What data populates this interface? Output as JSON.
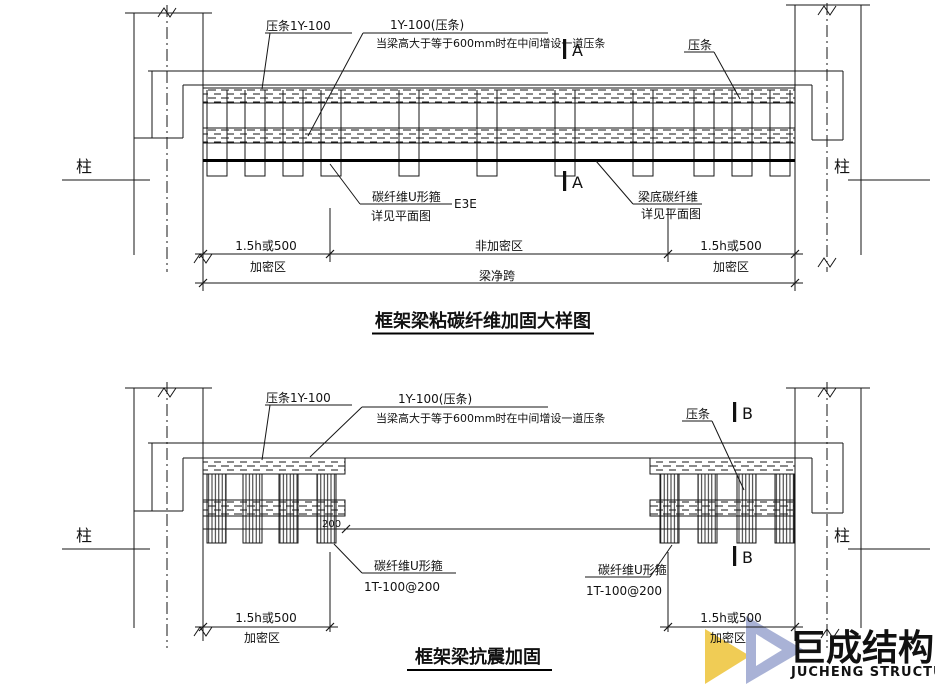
{
  "watermark": {
    "brand_cn": "巨成结构",
    "brand_en": "JUCHENG STRUCTURE",
    "brand_color": "#a9b2d6",
    "accent_yellow": "#f0cc55",
    "en_color": "#b3b3b3"
  },
  "diagram_top": {
    "title": "框架梁粘碳纤维加固大样图",
    "labels": {
      "batten_left": "压条1Y-100",
      "batten_mid_1": "1Y-100(压条)",
      "batten_mid_2": "当梁高大于等于600mm时在中间增设一道压条",
      "batten_right": "压条",
      "section_mark": "A",
      "uhoop_1": "碳纤维U形箍",
      "uhoop_suffix": "E3E",
      "uhoop_2": "详见平面图",
      "bottom_frp_1": "梁底碳纤维",
      "bottom_frp_2": "详见平面图",
      "column": "柱"
    },
    "dims": {
      "zone_len": "1.5h或500",
      "zone": "加密区",
      "mid_zone": "非加密区",
      "span": "梁净跨"
    }
  },
  "diagram_bottom": {
    "title": "框架梁抗震加固",
    "labels": {
      "batten_left": "压条1Y-100",
      "batten_mid_1": "1Y-100(压条)",
      "batten_mid_2": "当梁高大于等于600mm时在中间增设一道压条",
      "batten_right": "压条",
      "section_mark": "B",
      "uhoop_name": "碳纤维U形箍",
      "uhoop_spec": "1T-100@200",
      "spacing": "200",
      "column": "柱"
    },
    "dims": {
      "zone_len": "1.5h或500",
      "zone": "加密区"
    }
  }
}
